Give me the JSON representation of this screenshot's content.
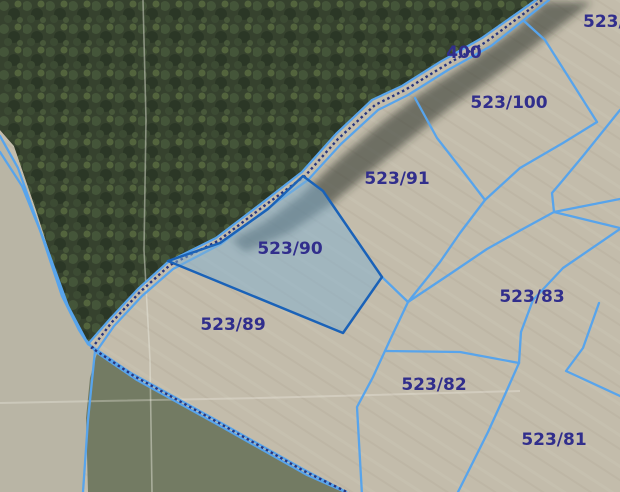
{
  "map": {
    "type": "cadastral-parcel-map-over-aerial-imagery",
    "labels": [
      {
        "id": "road-400",
        "text": "400"
      },
      {
        "id": "parcel-523",
        "text": "523/"
      },
      {
        "id": "parcel-523-100",
        "text": "523/100"
      },
      {
        "id": "parcel-523-91",
        "text": "523/91"
      },
      {
        "id": "parcel-523-90",
        "text": "523/90"
      },
      {
        "id": "parcel-523-89",
        "text": "523/89"
      },
      {
        "id": "parcel-523-83",
        "text": "523/83"
      },
      {
        "id": "parcel-523-82",
        "text": "523/82"
      },
      {
        "id": "parcel-523-81",
        "text": "523/81"
      }
    ],
    "selected_parcel": {
      "id": "523/90",
      "fill": "#7fb0d2",
      "fill_opacity": "0.5",
      "border": "#1a62b8"
    },
    "colors": {
      "boundary_line": "#58a4eb",
      "hatch_line": "#27357f",
      "label_text": "#312e8c"
    }
  }
}
